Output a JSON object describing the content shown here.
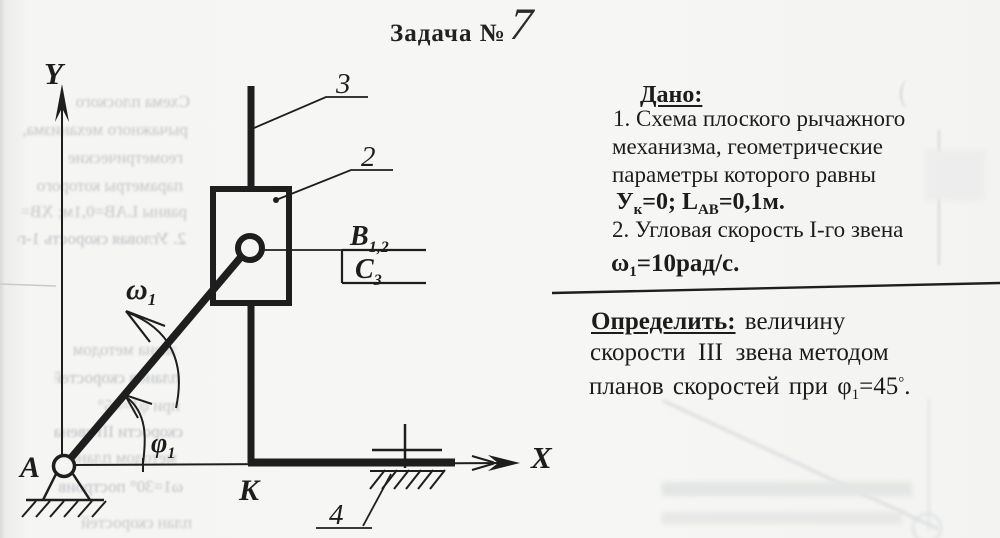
{
  "title": {
    "label": "Задача №",
    "number": "7"
  },
  "given": {
    "heading": "Дано:",
    "line1": "1. Схема плоского рычажного",
    "line2": "механизма, геометрические",
    "line3": "параметры которого равны",
    "y_base": "У",
    "y_sub": "к",
    "y_eq": "=0; ",
    "l_base": "L",
    "l_sub": "АВ",
    "l_eq": "=0,1м.",
    "line5": "2. Угловая скорость I-го звена",
    "omega_base": "ω",
    "omega_sub": "1",
    "omega_eq": "=10рад/с."
  },
  "find": {
    "heading": "Определить:",
    "heading_rest": " величину",
    "line2": "скорости  III  звена методом",
    "line3_pre": "планов скоростей при ",
    "phi_base": "φ",
    "phi_sub": "1",
    "phi_eq": "=45",
    "phi_deg": "°",
    "phi_end": "."
  },
  "diagram": {
    "y_label": "Y",
    "x_label": "X",
    "point_a": "A",
    "point_k": "K",
    "num_2": "2",
    "num_3": "3",
    "num_4": "4",
    "b_label": "B",
    "b_sub": "1,2",
    "c_label": "C",
    "c_sub": "3",
    "omega_label": "ω",
    "omega_sub": "1",
    "phi_label": "φ",
    "phi_sub": "1"
  },
  "bleed_left": [
    {
      "text": "Схема плоского"
    },
    {
      "text": "рычажного механизма,"
    },
    {
      "text": "геометрические"
    },
    {
      "text": "параметры которого"
    },
    {
      "text": "равны LAB=0,1м; XB=0."
    },
    {
      "text": "2. Угловая скорость 1-го"
    },
    {
      "text": "звена методом"
    },
    {
      "text": "планов скоростей"
    },
    {
      "text": "при φ1=45°"
    },
    {
      "text": "скорости III звена"
    },
    {
      "text": "методом планов"
    },
    {
      "text": "ω1=30° построив"
    },
    {
      "text": "план скоростей"
    }
  ]
}
